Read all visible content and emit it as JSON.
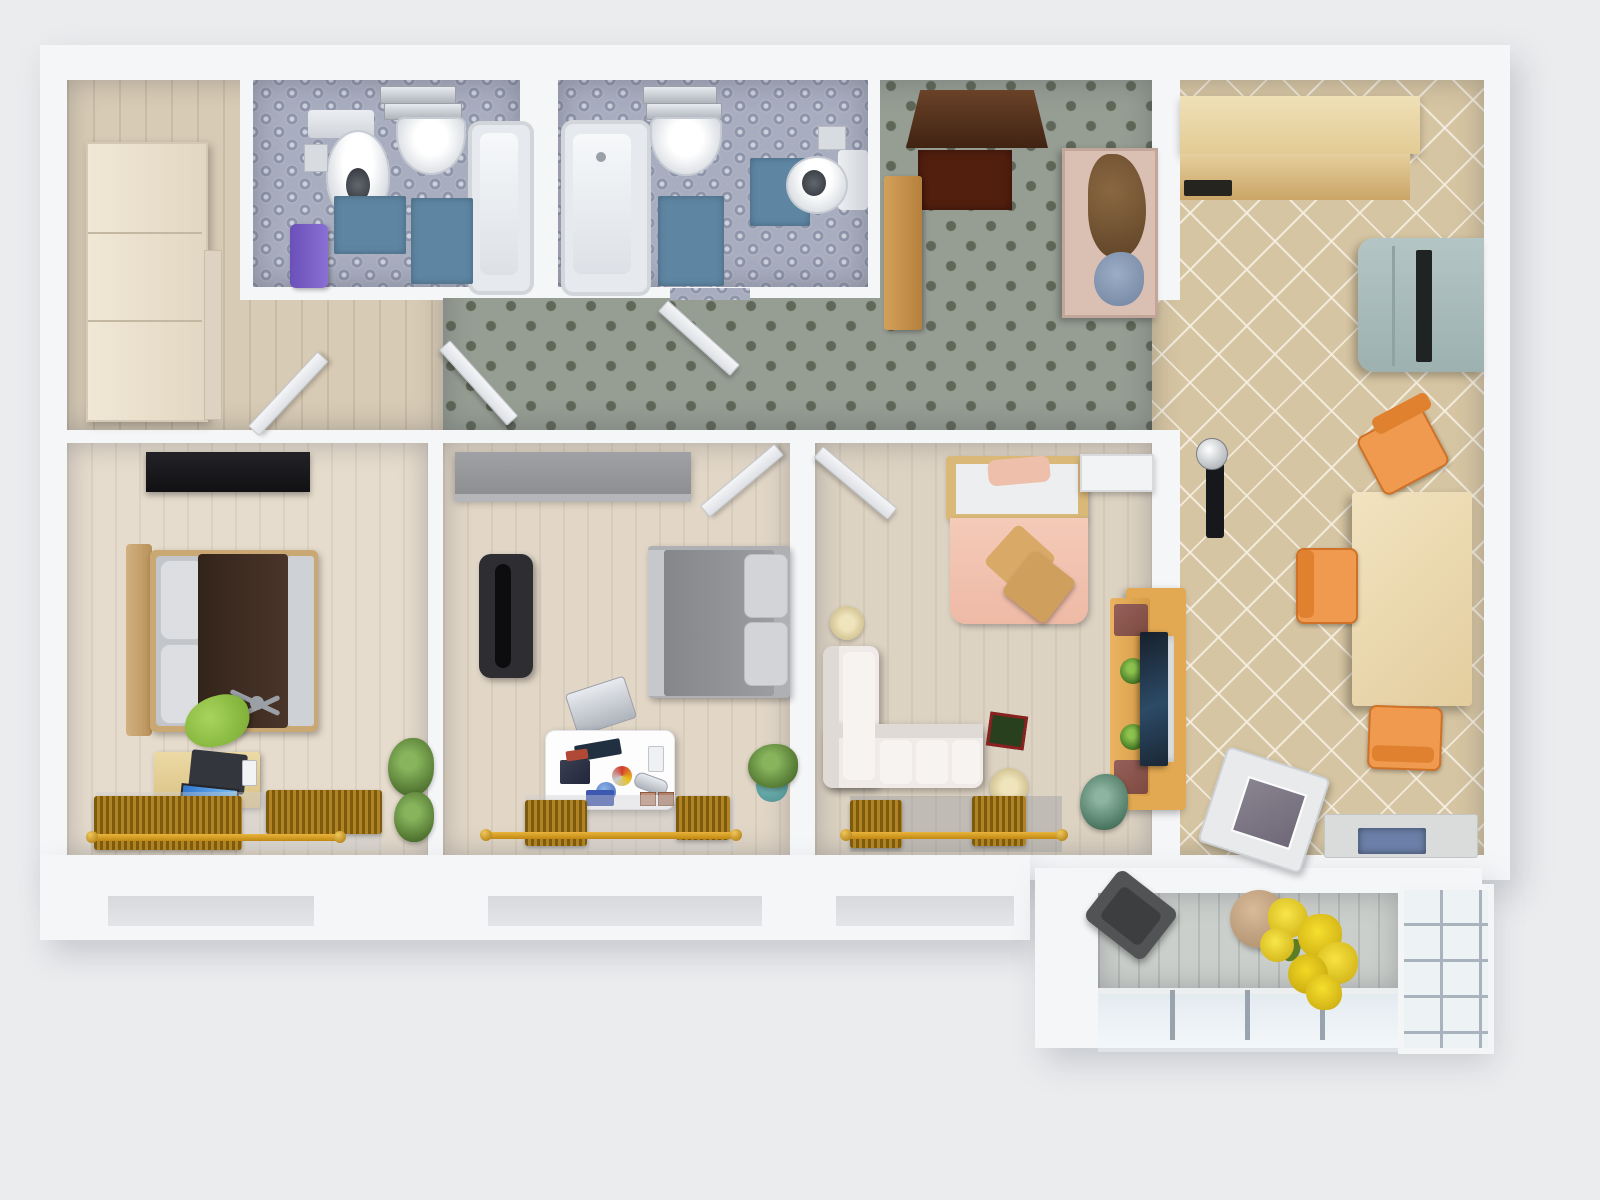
{
  "meta": {
    "title": "3D rendered apartment floor plan, top-down view"
  },
  "palette": {
    "bg": "#ebecee",
    "wall": "#f5f6f8",
    "carpet": "#969d93",
    "carpet_dot": "#606758",
    "wood_floor": "#d8cbb5",
    "floor_bed1": "#e6dccd",
    "floor_bed2": "#e2d7c7",
    "floor_living": "#ddd3c3",
    "tile_kitchen": "#d6c5a2",
    "tile_bath": "#a8adbf",
    "mat_blue": "#5e86a3",
    "balcony_floor": "#cbcfcb",
    "fridge": "#aabfbe",
    "chair_orange": "#ef9a4f",
    "table_wood": "#eedcb4",
    "counter_wood": "#e2c186",
    "duvet_brown": "#3a2a1d",
    "bed_gray": "#95979b",
    "bed_pink": "#f2c6b4",
    "sofa_white": "#f0ebe8",
    "radiator_gold": "#b08324",
    "door_brown": "#5a3420",
    "mat_red": "#521f0e",
    "towel_purple": "#7a62c4",
    "chair_green": "#8cc23c",
    "tv_wood": "#e2a852",
    "flower_yellow": "#f2d825"
  },
  "rooms": [
    {
      "id": "entry-hall",
      "name": "Entry hall",
      "items": [
        "front door",
        "doormat",
        "shoe cabinet",
        "coat closet"
      ]
    },
    {
      "id": "hallway",
      "name": "Hallway",
      "items": [
        "diamond-pattern carpet",
        "open door"
      ]
    },
    {
      "id": "wardrobe-hall",
      "name": "Wardrobe hall",
      "items": [
        "wardrobe"
      ]
    },
    {
      "id": "bathroom-1",
      "name": "Bathroom 1",
      "items": [
        "toilet",
        "washbasin",
        "bathtub",
        "bath mat",
        "purple towel",
        "chrome shelf"
      ]
    },
    {
      "id": "bathroom-2",
      "name": "Bathroom 2",
      "items": [
        "bathtub",
        "washbasin",
        "toilet",
        "bath mat",
        "toilet paper holder"
      ]
    },
    {
      "id": "kitchen",
      "name": "Kitchen",
      "items": [
        "kitchen cabinet",
        "counter with cooktop",
        "refrigerator",
        "dining table",
        "orange chair",
        "washing machine",
        "sink counter",
        "wall phone"
      ]
    },
    {
      "id": "bedroom-1",
      "name": "Bedroom 1",
      "items": [
        "black dresser",
        "double bed with brown duvet",
        "green office chair",
        "desk with laptop",
        "plant",
        "radiator",
        "curtain rail"
      ]
    },
    {
      "id": "bedroom-2",
      "name": "Bedroom 2",
      "items": [
        "gray wardrobe",
        "gray double bed",
        "dark cabinet",
        "hobby desk with clutter",
        "metal chair",
        "plant",
        "radiator",
        "curtain rail",
        "open door"
      ]
    },
    {
      "id": "living-room",
      "name": "Living room",
      "items": [
        "pink bed",
        "corner sofa",
        "tv stand",
        "tv",
        "white dresser",
        "round pouf",
        "board game",
        "plant",
        "radiator",
        "curtain rail",
        "open door"
      ]
    },
    {
      "id": "balcony",
      "name": "Balcony",
      "items": [
        "dark chair",
        "vase",
        "yellow flowers",
        "glass railing",
        "window wall"
      ]
    }
  ]
}
